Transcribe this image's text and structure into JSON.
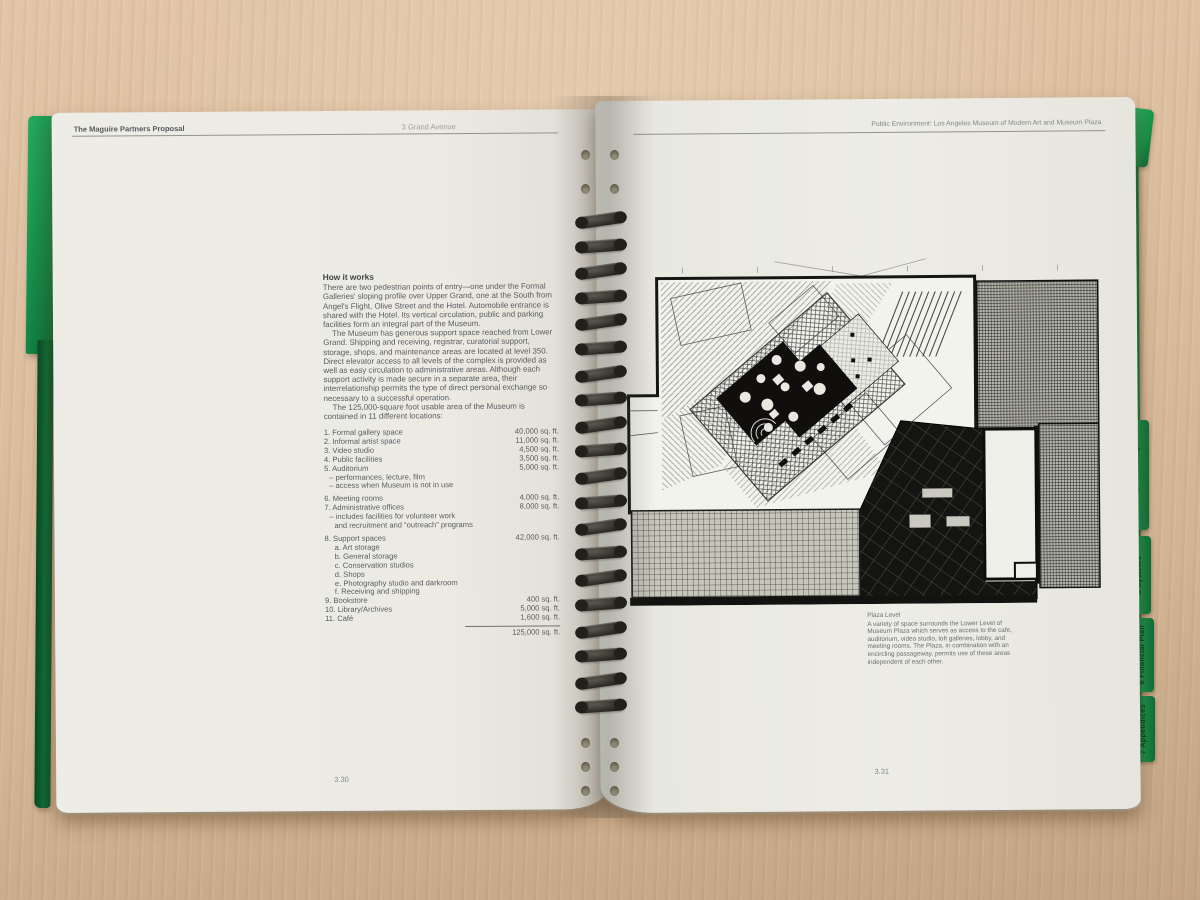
{
  "book": {
    "left_page": {
      "header": {
        "left": "The Maguire Partners Proposal",
        "center": "3 Grand Avenue"
      },
      "section_title": "How it works",
      "paragraphs": [
        "There are two pedestrian points of entry—one under the Formal Galleries' sloping profile over Upper Grand, one at the South from Angel's Flight, Olive Street and the Hotel. Automobile entrance is shared with the Hotel. Its vertical circulation, public and parking facilities form an integral part of the Museum.",
        "The Museum has generous support space reached from Lower Grand. Shipping and receiving, registrar, curatorial support, storage, shops, and maintenance areas are located at level 350. Direct elevator access to all levels of the complex is provided as well as easy circulation to administrative areas. Although each support activity is made secure in a separate area, their interrelationship permits the type of direct personal exchange so necessary to a successful operation.",
        "The 125,000-square foot usable area of the Museum is contained in 11 different locations:"
      ],
      "space_list": {
        "rows": [
          {
            "label": "1. Formal gallery space",
            "value": "40,000 sq. ft."
          },
          {
            "label": "2. Informal artist space",
            "value": "11,000 sq. ft."
          },
          {
            "label": "3. Video studio",
            "value": "4,500 sq. ft."
          },
          {
            "label": "4. Public facilities",
            "value": "3,500 sq. ft."
          },
          {
            "label": "5. Auditorium",
            "value": "5,000 sq. ft."
          },
          {
            "label": "– performances, lecture, film"
          },
          {
            "label": "– access when Museum is not in use"
          },
          {
            "label": "6. Meeting rooms",
            "value": "4,000 sq. ft."
          },
          {
            "label": "7. Administrative offices",
            "value": "8,000 sq. ft."
          },
          {
            "label": "– includes facilities for volunteer work"
          },
          {
            "label": "and recruitment and “outreach” programs"
          },
          {
            "label": "8. Support spaces",
            "value": "42,000 sq. ft."
          },
          {
            "label": "a. Art storage"
          },
          {
            "label": "b. General storage"
          },
          {
            "label": "c. Conservation studios"
          },
          {
            "label": "d. Shops"
          },
          {
            "label": "e. Photography studio and darkroom"
          },
          {
            "label": "f. Receiving and shipping"
          },
          {
            "label": "9. Bookstore",
            "value": "400 sq. ft."
          },
          {
            "label": "10. Library/Archives",
            "value": "5,000 sq. ft."
          },
          {
            "label": "11. Café",
            "value": "1,600 sq. ft."
          }
        ],
        "total": "125,000 sq. ft."
      },
      "page_number": "3.30"
    },
    "right_page": {
      "header": "Public Environment: Los Angeles Museum of Modern Art and Museum Plaza",
      "figure": {
        "caption_title": "Plaza Level",
        "caption_body": "A variety of space surrounds the Lower Level of Museum Plaza which serves as access to the cafe, auditorium, video studio, loft galleries, lobby, and meeting rooms. The Plaza, in combination with an encircling passageway, permits use of these areas independent of each other."
      },
      "page_number": "3.31"
    },
    "side_tabs": [
      {
        "label": "4 Major Buildings"
      },
      {
        "label": "5 Systems"
      },
      {
        "label": "6 Financial Plan"
      },
      {
        "label": "7 Appendices"
      }
    ]
  },
  "colors": {
    "cover_green": "#0f7f40",
    "page": "#eceae3",
    "desk_wood": "#d9bd9e",
    "plan_ink": "#141412"
  }
}
